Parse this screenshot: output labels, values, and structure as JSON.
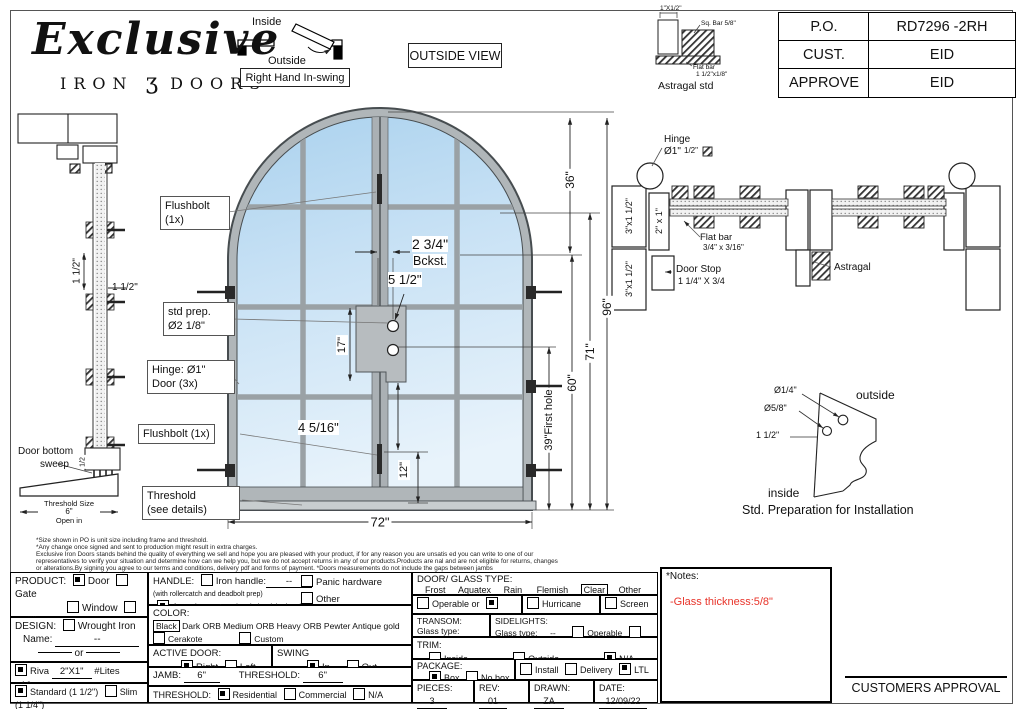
{
  "title_block": {
    "po_label": "P.O.",
    "po_value": "RD7296 -2RH",
    "cust_label": "CUST.",
    "cust_value": "EID",
    "approve_label": "APPROVE",
    "approve_value": "EID"
  },
  "logo": {
    "script": "Exclusive",
    "word1": "IRON",
    "glyph": "ʒ",
    "word2": "DOORS"
  },
  "swing_diagram": {
    "inside": "Inside",
    "outside": "Outside",
    "caption": "Right Hand In-swing"
  },
  "view_label": "OUTSIDE VIEW",
  "astragal_std": {
    "dim_top": "1\"X1/2\"",
    "sq_bar": "Sq. Bar 5/8\"",
    "flat_bar1": "Flat bar",
    "flat_bar2": "1 1/2\"x1/8\"",
    "caption": "Astragal std"
  },
  "left_section": {
    "dim_v": "1 1/2\"",
    "dim_h": "1 1/2\"",
    "sweep1": "Door bottom",
    "sweep2": "sweep",
    "sweep_dim": "1/2",
    "th1": "Threshold Size",
    "th2": "6\"",
    "th3": "Open in"
  },
  "elevation": {
    "callouts": {
      "flushbolt_top1": "Flushbolt",
      "flushbolt_top2": "(1x)",
      "std_prep1": "std prep.",
      "std_prep2": "Ø2 1/8\"",
      "hinge1": "Hinge: Ø1\"",
      "hinge2": "Door (3x)",
      "flushbolt_bottom": "Flushbolt (1x)",
      "threshold1": "Threshold",
      "threshold2": "(see details)"
    },
    "dims": {
      "backset": "2 3/4\"",
      "backset_lbl": "Bckst.",
      "bore_top": "5 1/2\"",
      "bore_span": "17\"",
      "bolt": "4 5/16\"",
      "bottom_bolt": "12\"",
      "width": "72\"",
      "arch": "36\"",
      "height": "96\"",
      "h71": "71\"",
      "h60": "60\"",
      "first_hole": "39\"First hole"
    }
  },
  "plan_section": {
    "hinge1": "Hinge",
    "hinge2": "Ø1\"",
    "half_sq": "1/2\"",
    "tube_v": "2\" x 1\"",
    "jamb_a": "3\"x1 1/2\"",
    "jamb_b": "3\"x1 1/2\"",
    "flat1": "Flat bar",
    "flat2": "3/4\" x 3/16\"",
    "stop1": "Door Stop",
    "stop2": "1 1/4\" X 3/4",
    "astragal": "Astragal"
  },
  "install": {
    "d1": "Ø1/4\"",
    "d2": "Ø5/8\"",
    "d3": "1 1/2\"",
    "outside": "outside",
    "inside": "inside",
    "caption": "Std. Preparation for Installation"
  },
  "disclaimer": {
    "l1": "*Size shown in PO is unit size including frame and threshold.",
    "l2": "*Any change once signed and sent to production might result in extra charges.",
    "l3": "Exclusive Iron Doors stands behind the quality of everything we sell and hope you are pleased with your product, if for any reason you are unsatis ed you can write to one of our",
    "l4": "representatives to verify your situation and determine how can we help you, but we do not accept returns in any of our products.Products are nal and are not eligible for returns, changes",
    "l5": "or alterations.By signing you agree to our terms and conditions, delivery pdf and forms of payment. *Doors measurements do not include the gaps between jambs"
  },
  "form": {
    "product": {
      "label": "PRODUCT:",
      "door": "Door",
      "gate": "Gate",
      "window": "Window",
      "railing": "Railling",
      "other": "Other",
      "other_val": "--"
    },
    "design": {
      "label": "DESIGN:",
      "wrought": "Wrought Iron",
      "name_label": "Name:",
      "name_val": "--",
      "or_label": "or"
    },
    "riva": {
      "name": "Riva",
      "size": "2\"X1\"",
      "lites_label": "#Lites",
      "lites_val": "16"
    },
    "frame": {
      "standard": "Standard (1 1/2\")",
      "slim": "Slim (1 1/4\")"
    },
    "handle": {
      "label": "HANDLE:",
      "iron": "Iron handle:",
      "iron_val": "--",
      "iron_note": "(with rollercatch and deadbolt prep)",
      "american": "American standard double boring",
      "panic": "Panic hardware",
      "other": "Other"
    },
    "color": {
      "label": "COLOR:",
      "black": "Black",
      "dark": "Dark ORB",
      "medium": "Medium ORB",
      "heavy": "Heavy ORB",
      "pewter": "Pewter",
      "antique": "Antique gold",
      "cerakote": "Cerakote",
      "custom": "Custom"
    },
    "active_door": {
      "label": "ACTIVE DOOR:",
      "right": "Right",
      "left": "Left"
    },
    "swing": {
      "label": "SWING",
      "in": "In",
      "out": "Out"
    },
    "jamb": {
      "label": "JAMB:",
      "val": "6\"",
      "th_label": "THRESHOLD:",
      "th_val": "6\""
    },
    "threshold": {
      "label": "THRESHOLD:",
      "res": "Residential",
      "com": "Commercial",
      "na": "N/A",
      "na_val": ""
    },
    "glass": {
      "label": "DOOR/ GLASS TYPE:",
      "frost": "Frost",
      "aquatex": "Aquatex",
      "rain": "Rain",
      "flemish": "Flemish",
      "clear": "Clear",
      "other": "Other",
      "operable": "Operable",
      "or_label": "or",
      "fixed": "Fixed",
      "hurricane": "Hurricane film",
      "screen": "Screen"
    },
    "transom": {
      "label": "TRANSOM:",
      "glass_label": "Glass type:",
      "val": "--"
    },
    "sidelights": {
      "label": "SIDELIGHTS:",
      "glass_label": "Glass type:",
      "val": "--",
      "operable": "Operable",
      "fixed": "Fixed"
    },
    "trim": {
      "label": "TRIM:",
      "inside": "Inside",
      "inside_val": "--",
      "outside": "Outside",
      "outside_val": "--",
      "na": "N/A"
    },
    "package": {
      "label": "PACKAGE:",
      "box": "Box",
      "nobox": "No box",
      "install": "Install",
      "delivery": "Delivery",
      "ltl": "LTL"
    },
    "pieces": {
      "label": "PIECES:",
      "val": "3"
    },
    "rev": {
      "label": "REV:",
      "val": "01"
    },
    "drawn": {
      "label": "DRAWN:",
      "val": "ZA"
    },
    "date": {
      "label": "DATE:",
      "val": "12/09/22"
    }
  },
  "notes": {
    "title": "*Notes:",
    "note": "-Glass thickness:5/8\"",
    "note_color": "#e8342a"
  },
  "approval": {
    "label": "CUSTOMERS APPROVAL"
  }
}
